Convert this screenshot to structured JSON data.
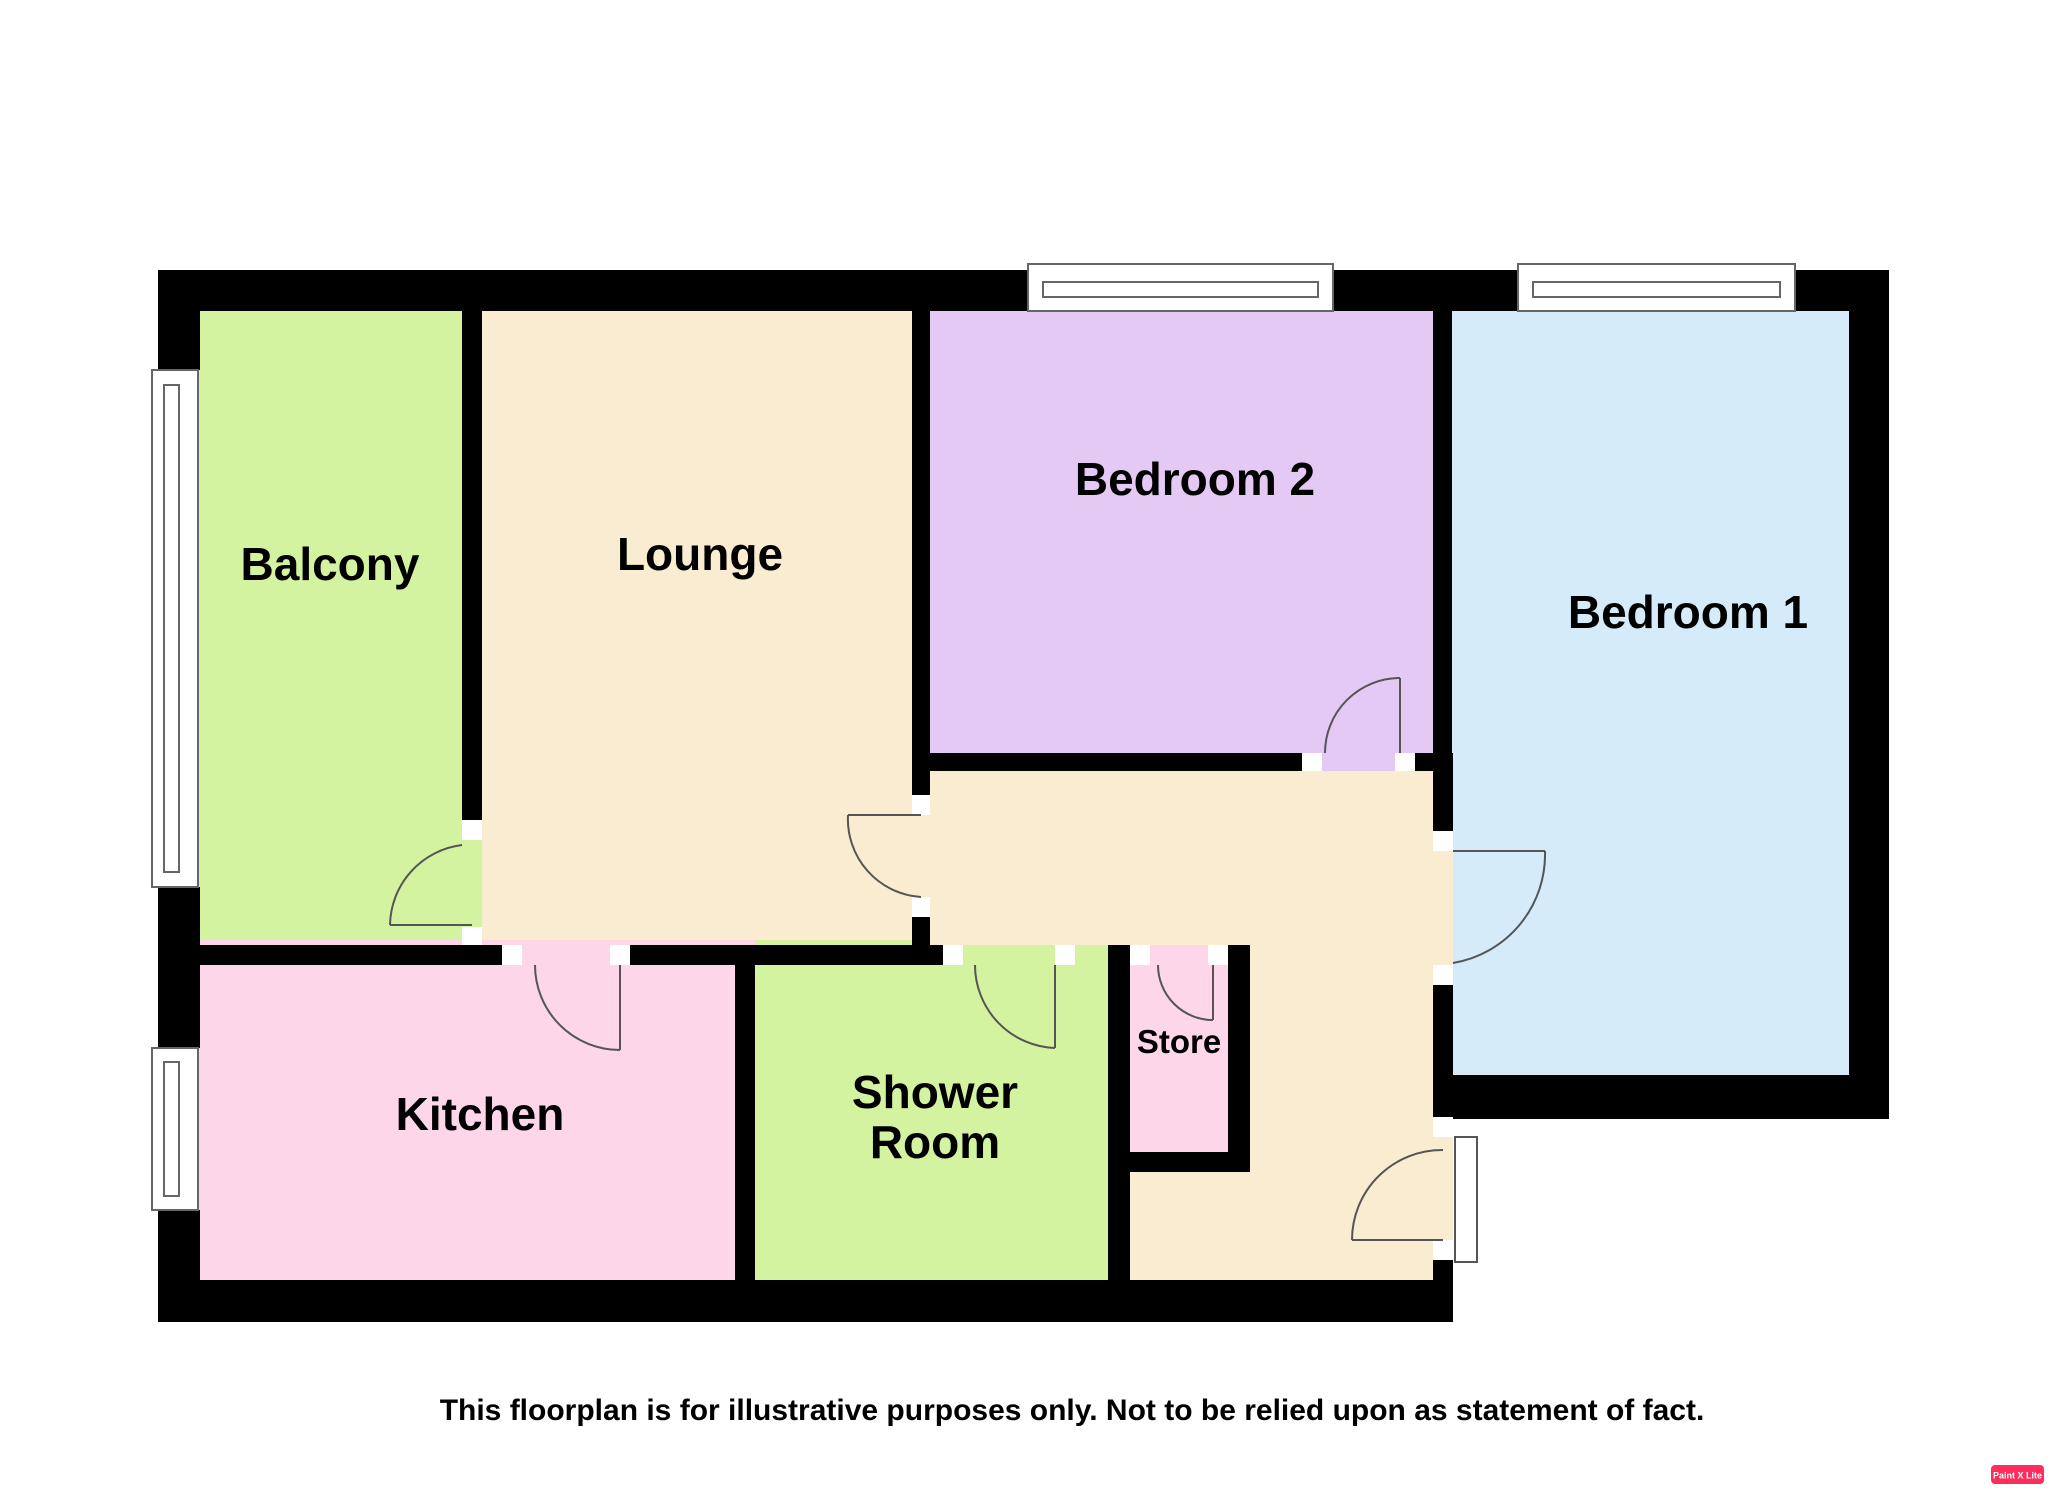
{
  "disclaimer": "This floorplan is for illustrative purposes only. Not to be relied upon as statement of fact.",
  "watermark": {
    "label": "Paint X Lite",
    "bg_color": "#fb2e5d",
    "text_color": "#ffffff"
  },
  "colors": {
    "background": "#ffffff",
    "wall": "#000000",
    "door_stroke": "#555555",
    "window_stroke": "#666666",
    "jamb_fill": "#ffffff",
    "label_text": "#000000"
  },
  "rooms": [
    {
      "name": "Balcony",
      "color": "#d4f3a1"
    },
    {
      "name": "Lounge",
      "color": "#faecd1"
    },
    {
      "name": "Bedroom 2",
      "color": "#e4c9f5"
    },
    {
      "name": "Bedroom 1",
      "color": "#d5ebfa"
    },
    {
      "name": "Kitchen",
      "color": "#fdd6e9"
    },
    {
      "name": "Shower Room",
      "lines": [
        "Shower",
        "Room"
      ],
      "color": "#d4f3a1"
    },
    {
      "name": "Store",
      "color": "#fdd6e9"
    }
  ],
  "hallway_color": "#faecd1"
}
